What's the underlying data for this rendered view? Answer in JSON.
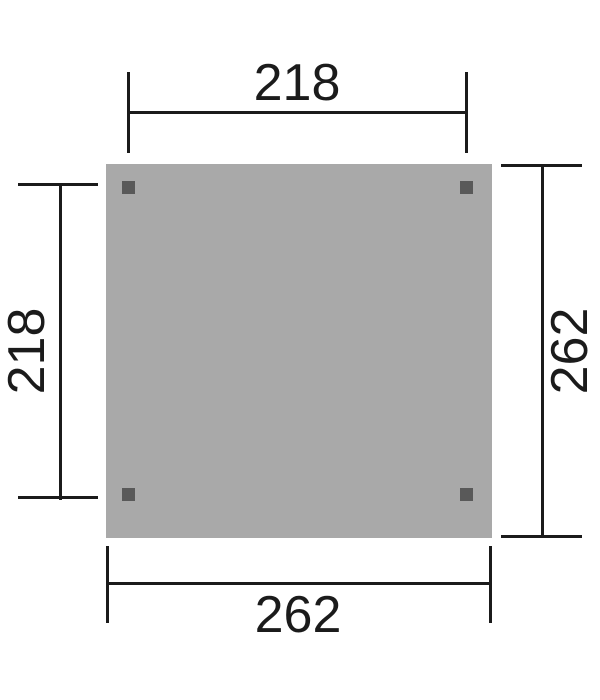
{
  "drawing": {
    "dimensions": {
      "top": "218",
      "left": "218",
      "right": "262",
      "bottom": "262"
    },
    "colors": {
      "background": "#ffffff",
      "surface": "#a9a9a9",
      "post": "#595959",
      "line": "#1b1b1b"
    },
    "post_markers": [
      "top-left",
      "top-right",
      "bottom-left",
      "bottom-right"
    ]
  }
}
